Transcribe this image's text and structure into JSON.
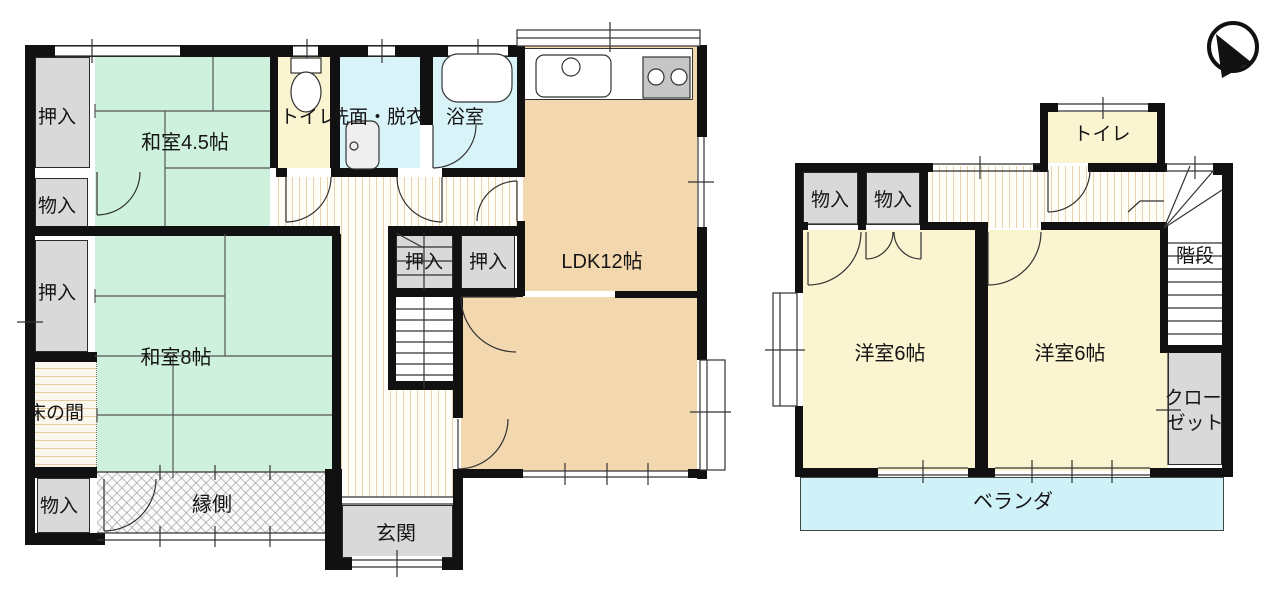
{
  "palette": {
    "wall": "#111111",
    "line": "#333333",
    "tatami_green": "#cdf1dc",
    "wood_peach": "#f3d7af",
    "cream_yellow": "#faf4d0",
    "aqua": "#d9f4f9",
    "veranda_blue": "#cff1f8",
    "closet_gray": "#d9d9d9",
    "hall_stripe": "#ead3ab",
    "tokonoma_stripe": "#e6cba2"
  },
  "floor1": {
    "labels": {
      "oshiire_top": "押入",
      "washitsu45": "和室4.5帖",
      "toilet": "トイレ",
      "senmen_datsui": "洗面・脱衣",
      "bathroom": "浴室",
      "ldk": "LDK12帖",
      "monoire_upper": "物入",
      "oshiire_mid": "押入",
      "washitsu8": "和室8帖",
      "tokonoma": "床の間",
      "monoire_lower": "物入",
      "engawa": "縁側",
      "genkan": "玄関",
      "oshiire_hall_left": "押入",
      "oshiire_hall_right": "押入"
    }
  },
  "floor2": {
    "labels": {
      "toilet": "トイレ",
      "monoire_left": "物入",
      "monoire_right": "物入",
      "stairs": "階段",
      "west_room_left": "洋室6帖",
      "west_room_right": "洋室6帖",
      "closet_line1": "クロー",
      "closet_line2": "ゼット",
      "veranda": "ベランダ"
    }
  }
}
